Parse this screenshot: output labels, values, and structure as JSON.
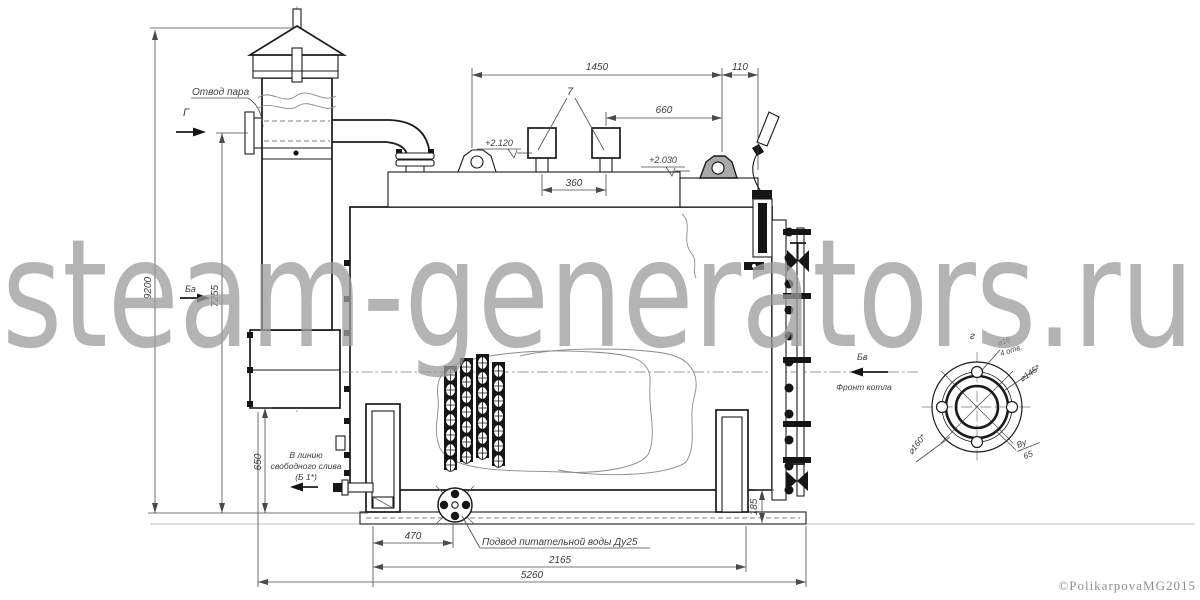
{
  "watermark": {
    "text": "steam-generators.ru"
  },
  "footer": {
    "copyright": "©PolikarpovaMG2015"
  },
  "drawing": {
    "labels": {
      "steam_outlet": "Отвод пара",
      "feed_water": "Подвод питательной воды Ду25",
      "drain_line1": "В линию",
      "drain_line2": "свободного слива",
      "drain_line3": "(Б 1*)",
      "boiler_front": "Фронт котла"
    },
    "callouts": {
      "safety_valves": "7"
    },
    "view_markers": {
      "top_left": "Г",
      "mid_left": "Ба",
      "right": "Бв",
      "detail": "г"
    },
    "elevations": {
      "left": "+2.120",
      "right": "+2.030"
    },
    "dimensions": {
      "top_width": "1450",
      "top_offset": "110",
      "valves_offset": "660",
      "valves_spacing": "360",
      "total_height": "9200",
      "outlet_height": "7255",
      "drain_height": "650",
      "feed_offset": "470",
      "frame_length": "2165",
      "total_length": "5260",
      "base_height": "185"
    },
    "flange_detail": {
      "holes_dia": "⌀16",
      "holes_count": "4 отв.",
      "bolt_circle_dia": "⌀145*",
      "outer_dia": "⌀160*",
      "nominal_label": "Ву",
      "nominal_value": "65"
    }
  }
}
